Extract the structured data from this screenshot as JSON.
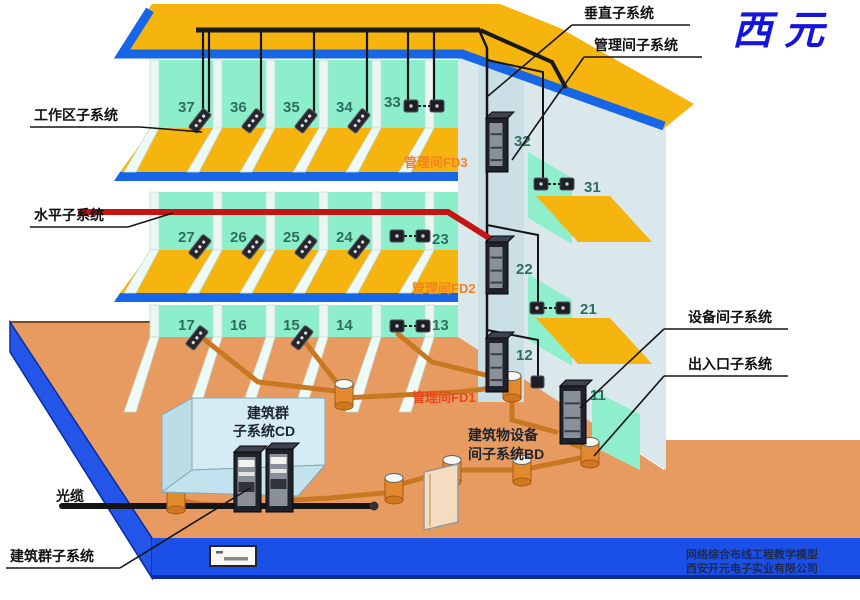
{
  "logo": {
    "text": "西元"
  },
  "callouts": {
    "vertical": "垂直子系统",
    "mgmt_room": "管理间子系统",
    "work_area": "工作区子系统",
    "horizontal": "水平子系统",
    "equipment_room": "设备间子系统",
    "entrance": "出入口子系统",
    "campus": "建筑群子系统",
    "optical_cable": "光缆"
  },
  "annotations": {
    "fd3": "管理间FD3",
    "fd2": "管理间FD2",
    "fd1": "管理间FD1"
  },
  "campus_box": {
    "line1": "建筑群",
    "line2": "子系统CD"
  },
  "building_equipment": {
    "line1": "建筑物设备",
    "line2": "间子系统BD"
  },
  "floors": [
    {
      "level": 3,
      "rooms": [
        "37",
        "36",
        "35",
        "34",
        "33"
      ],
      "right_rooms": [
        "32",
        "31"
      ]
    },
    {
      "level": 2,
      "rooms": [
        "27",
        "26",
        "25",
        "24",
        "23"
      ],
      "right_rooms": [
        "22",
        "21"
      ]
    },
    {
      "level": 1,
      "rooms": [
        "17",
        "16",
        "15",
        "14",
        "13"
      ],
      "right_rooms": [
        "12",
        "11"
      ]
    }
  ],
  "footer": {
    "line1": "网络综合布线工程教学模型",
    "line2": "西安开元电子实业有限公司"
  },
  "colors": {
    "roof_floor_yellow": "#F6B40F",
    "slab_blue": "#1766E8",
    "wall_mint": "#8CEECB",
    "wall_pale": "#DAE7EB",
    "ground_orange": "#E89B60",
    "base_blue": "#1B50E8",
    "horizontal_cable_red": "#C41414",
    "conduit_orange": "#C87820",
    "fd_label_orange": "#F58220",
    "logo_blue": "#1414DC"
  }
}
